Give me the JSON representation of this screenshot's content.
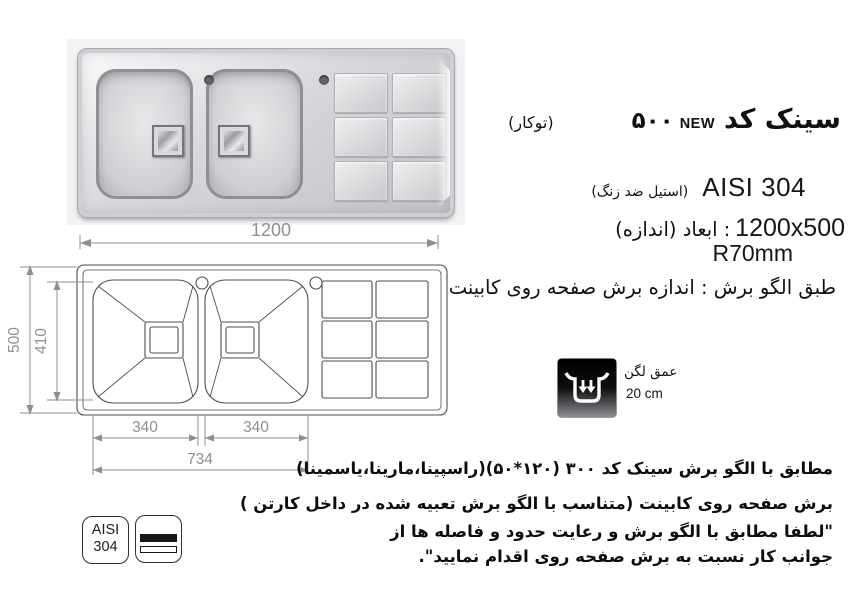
{
  "header": {
    "product": "سینک کد",
    "new_label": "NEW",
    "code": "۵۰۰",
    "mount_type": "(توکار)",
    "material": "AISI 304",
    "material_note": "(استیل ضد زنگ)",
    "dims_label": "ابعاد (اندازه)",
    "dims_colon": ":",
    "dims_value": "1200x500",
    "corner_radius": "R70mm",
    "cut_note": "طبق الگو برش : اندازه برش صفحه روی کابینت"
  },
  "photo_dim": {
    "width": "1200"
  },
  "drawing_dims": {
    "height": "500",
    "inner_height": "410",
    "bowl1_width": "340",
    "bowl2_width": "340",
    "bowls_span": "734"
  },
  "depth_badge": {
    "icon": "sink-depth-icon",
    "label": "عمق لگن",
    "value": "20 cm"
  },
  "notes": {
    "line1": "مطابق با الگو برش سینک کد ۳۰۰ (۱۲۰*۵۰)(راسپینا،مارینا،یاسمینا)",
    "line2": "برش صفحه روی کابینت (متناسب با الگو برش تعبیه شده در داخل کارتن )",
    "line3": "\"لطفا مطابق با الگو برش و رعایت حدود و فاصله ها از",
    "line4": "جوانب کار نسبت به برش صفحه روی اقدام نمایید\"."
  },
  "badges": {
    "material_line1": "AISI",
    "material_line2": "304",
    "steel_icon": "steel-sheet-icon"
  },
  "colors": {
    "dim_gray": "#8f8f8f",
    "drawing_line": "#4d4d4d",
    "text_black": "#111111",
    "photo_bg": "#f2f2f4"
  }
}
